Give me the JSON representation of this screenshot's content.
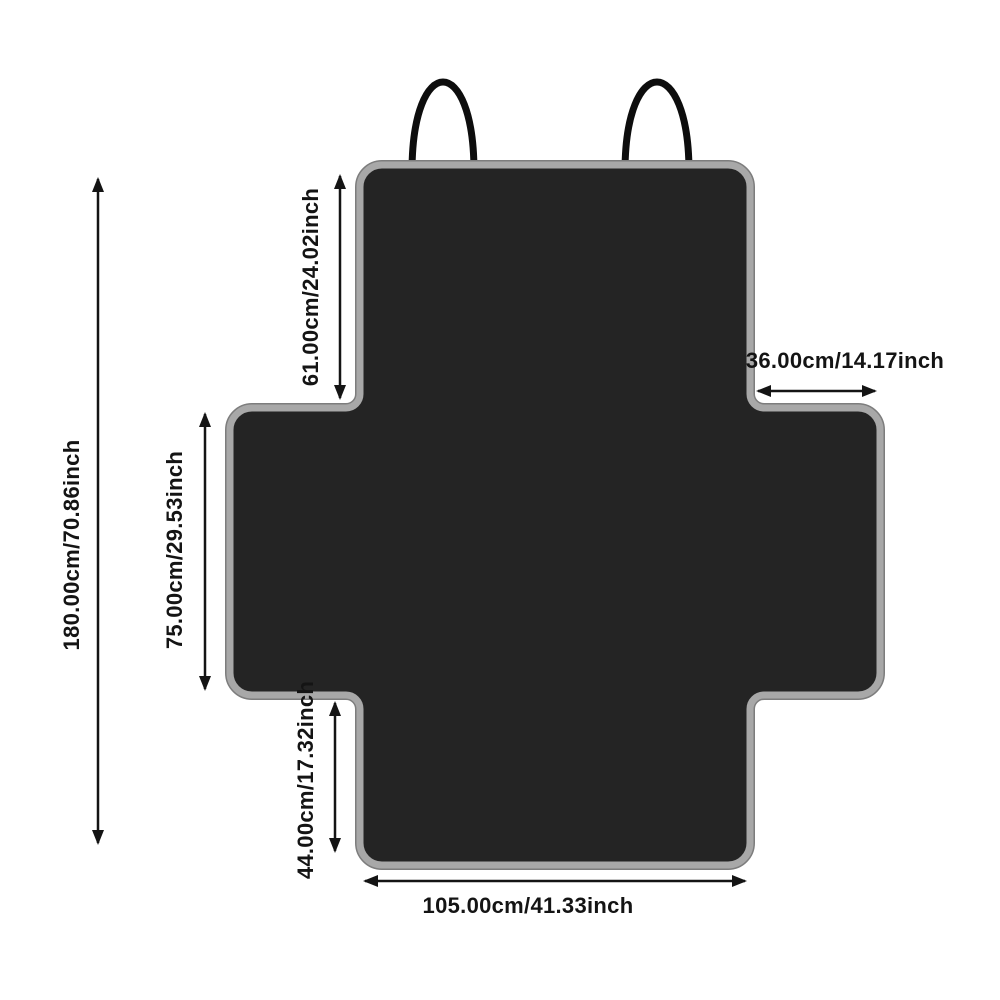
{
  "diagram": {
    "labels": {
      "total_height": "180.00cm/70.86inch",
      "top_flap_height": "61.00cm/24.02inch",
      "middle_height": "75.00cm/29.53inch",
      "bottom_flap_height": "44.00cm/17.32inch",
      "side_flap_width": "36.00cm/14.17inch",
      "bottom_width": "105.00cm/41.33inch"
    },
    "colors": {
      "background": "#ffffff",
      "cover_fill": "#242424",
      "cover_border": "#a8a8a8",
      "cover_border_outer": "#7d7d7d",
      "strap": "#0d0d0d",
      "dimension": "#141414"
    }
  }
}
